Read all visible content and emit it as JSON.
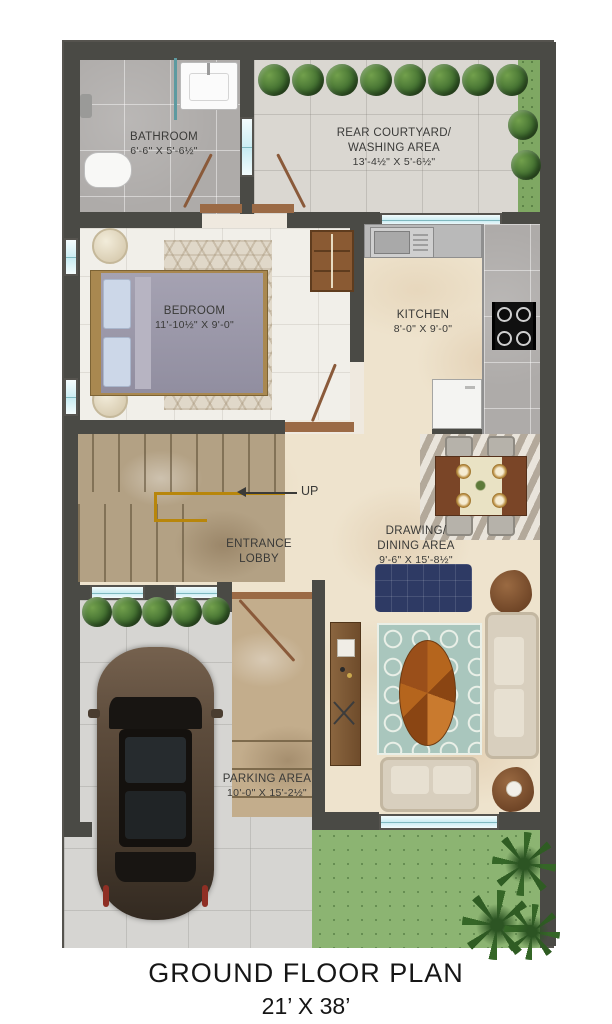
{
  "title": {
    "line1": "GROUND FLOOR PLAN",
    "line2": "21’ X 38’"
  },
  "labels": {
    "bathroom": {
      "name": "BATHROOM",
      "dim": "6'-6\" X 5'-6½\""
    },
    "courtyard": {
      "line1": "REAR COURTYARD/",
      "line2": "WASHING AREA",
      "dim": "13'-4½\" X 5'-6½\""
    },
    "bedroom": {
      "name": "BEDROOM",
      "dim": "11'-10½\" X 9'-0\""
    },
    "kitchen": {
      "name": "KITCHEN",
      "dim": "8'-0\" X 9'-0\""
    },
    "lobby": {
      "line1": "ENTRANCE",
      "line2": "LOBBY"
    },
    "drawing_dining": {
      "line1": "DRAWING/",
      "line2": "DINING AREA",
      "dim": "9'-6\" X 15'-8½\""
    },
    "parking": {
      "name": "PARKING  AREA",
      "dim": "10'-0\" X 15'-2½\""
    },
    "stairs_up": "UP"
  },
  "colors": {
    "wall": "#4a4a45",
    "window": "#c9ecf2",
    "door": "#8a5a3a",
    "lawn": "#8cb472",
    "beige": "#eee3cd",
    "stair": "#b3a184",
    "concrete": "#d6d5d2",
    "rugteal": "#a9c6bd",
    "navy": "#2e3a64",
    "sofa": "#d8cfbe",
    "gold": "#b8860b"
  }
}
